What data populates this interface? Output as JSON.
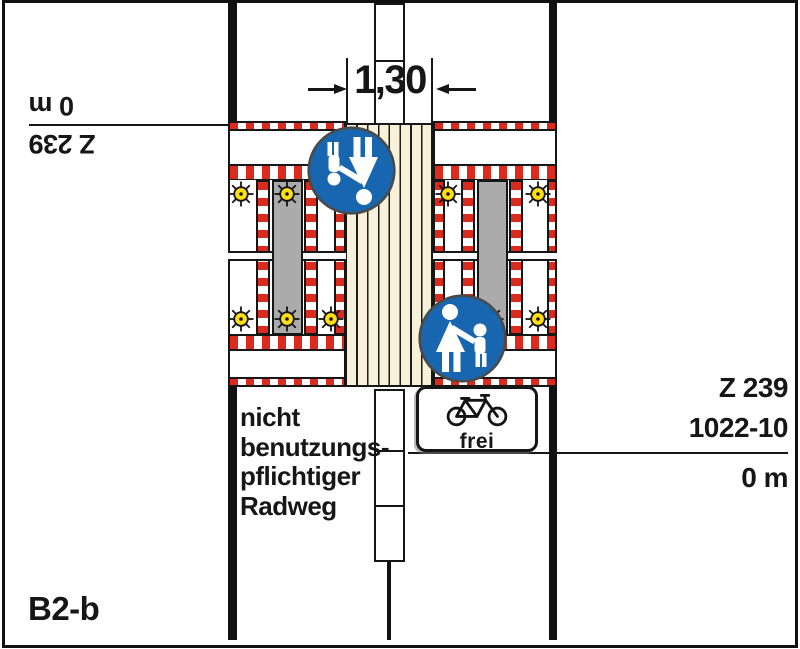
{
  "plan": {
    "code": "B2-b",
    "dimension_label": "1,30",
    "left_station": {
      "sign_ref": "Z 239",
      "distance": "0 m",
      "rotated": true
    },
    "right_station": {
      "sign_ref": "Z 239",
      "supplement_ref": "1022-10",
      "distance": "0 m"
    },
    "roadway_note": {
      "lines": [
        "nicht",
        "benutzungs-",
        "pflichtiger",
        "Radweg"
      ]
    },
    "frei_sign": {
      "label": "frei"
    },
    "icons": {
      "pedestrian_sign": "blue circular sign Z 239 adult with child",
      "pedestrian_sign_inverted": "same sign rotated 180 degrees for opposite direction",
      "bicycle": "bicycle pictogram on supplement plate 1022-10",
      "warning_lamp": "yellow warning light sunburst",
      "barrier": "red-white striped closure barrier"
    },
    "colors": {
      "barrier_red": "#DC2A1D",
      "sign_blue": "#1766AF",
      "lamp_yellow": "#FFDE14",
      "work_strip_gray": "#ABABAB",
      "footpath_cream": "#F6F1D8",
      "line_black": "#161616"
    }
  }
}
